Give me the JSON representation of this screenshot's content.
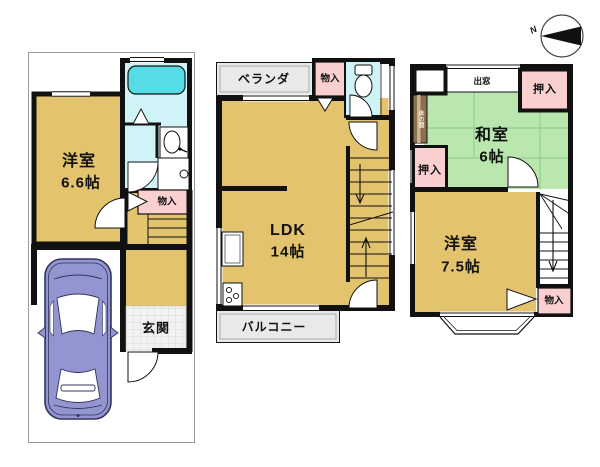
{
  "compass": {
    "north_label": "N"
  },
  "floor1": {
    "room": {
      "name": "洋室",
      "size": "6.6帖"
    },
    "storage_label": "物入",
    "entrance_label": "玄関"
  },
  "floor2": {
    "veranda_label": "ベランダ",
    "storage_label": "物入",
    "ldk": {
      "name": "LDK",
      "size": "14帖"
    },
    "balcony_label": "バルコニー"
  },
  "floor3": {
    "closet_top_label": "押入",
    "bay_window_label": "出窓",
    "tokonoma_label": "床の間",
    "closet_left_label": "押入",
    "washitsu": {
      "name": "和室",
      "size": "6帖"
    },
    "youshitsu": {
      "name": "洋室",
      "size": "7.5帖"
    },
    "storage_label": "物入"
  },
  "colors": {
    "room_tan": "#E3C36E",
    "tatami_green": "#B9E7AE",
    "closet_pink": "#F9CFCF",
    "bath_floor_cyan": "#CFF3F6",
    "bathtub_cyan": "#55DCE6",
    "outdoor_gray": "#E9E9E9",
    "car_purple": "#9295CF",
    "tokonoma_brown": "#8A6E4E",
    "wall_black": "#111111"
  }
}
